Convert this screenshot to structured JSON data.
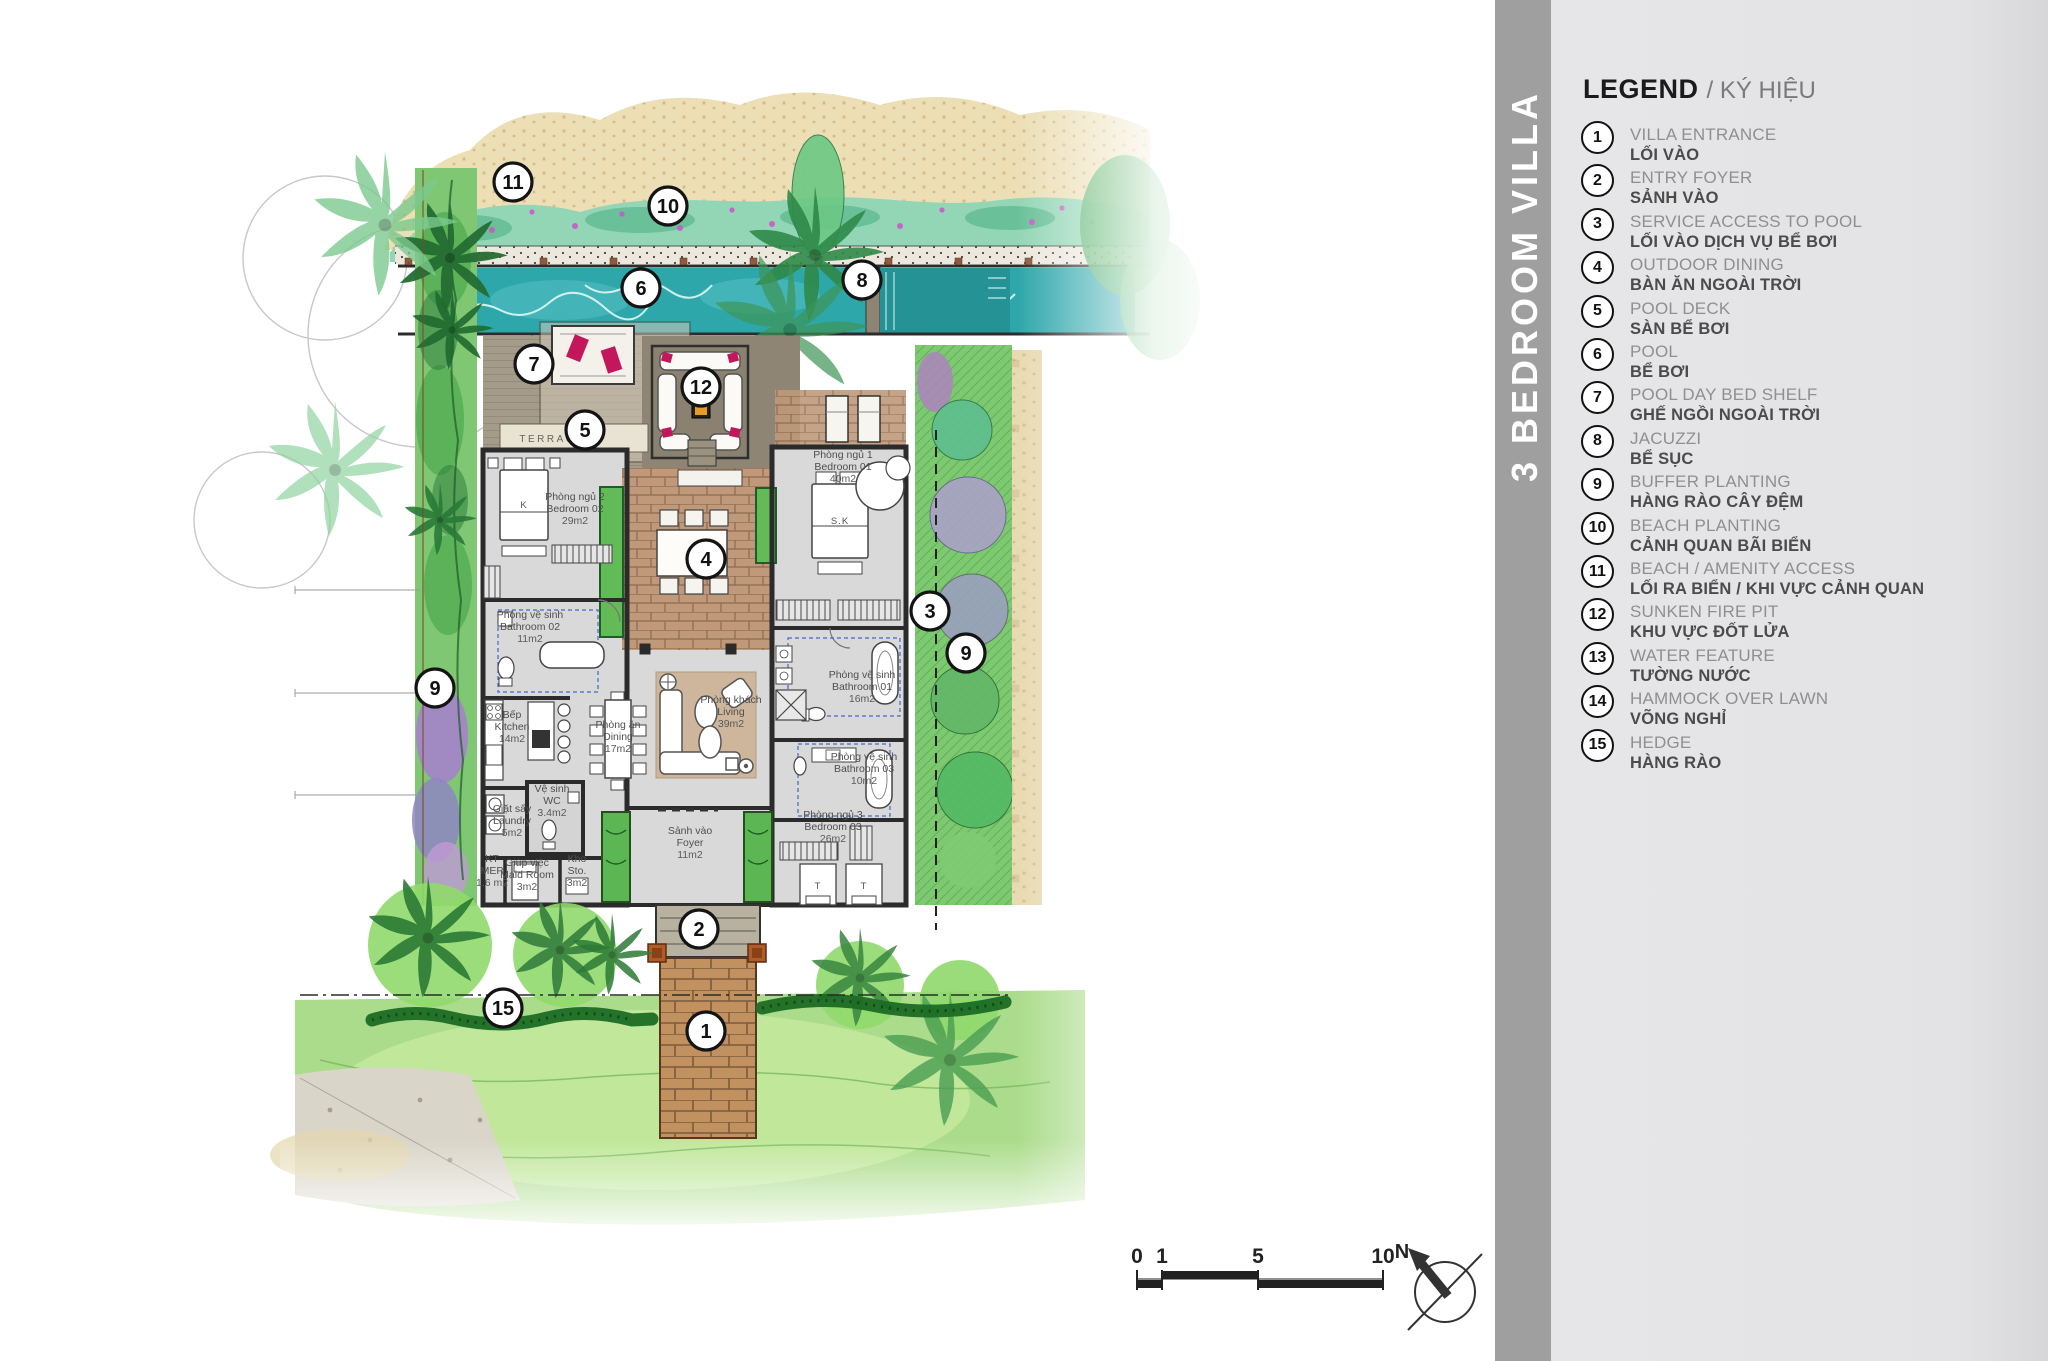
{
  "banner": {
    "title": "3 BEDROOM VILLA"
  },
  "legend": {
    "title": "LEGEND",
    "subtitle": "/ KÝ HIỆU",
    "items": [
      {
        "num": "1",
        "en": "VILLA ENTRANCE",
        "vi": "LỐI VÀO"
      },
      {
        "num": "2",
        "en": "ENTRY FOYER",
        "vi": "SẢNH VÀO"
      },
      {
        "num": "3",
        "en": "SERVICE ACCESS TO POOL",
        "vi": "LỐI VÀO DỊCH VỤ BỂ BƠI"
      },
      {
        "num": "4",
        "en": "OUTDOOR DINING",
        "vi": "BÀN ĂN NGOÀI TRỜI"
      },
      {
        "num": "5",
        "en": "POOL DECK",
        "vi": "SÀN BỂ BƠI"
      },
      {
        "num": "6",
        "en": "POOL",
        "vi": "BỂ BƠI"
      },
      {
        "num": "7",
        "en": "POOL DAY BED SHELF",
        "vi": "GHẾ NGỒI NGOÀI TRỜI"
      },
      {
        "num": "8",
        "en": "JACUZZI",
        "vi": "BỂ SỤC"
      },
      {
        "num": "9",
        "en": "BUFFER PLANTING",
        "vi": "HÀNG RÀO CÂY ĐỆM"
      },
      {
        "num": "10",
        "en": "BEACH PLANTING",
        "vi": "CẢNH QUAN BÃI BIỂN"
      },
      {
        "num": "11",
        "en": "BEACH / AMENITY ACCESS",
        "vi": "LỐI RA BIỂN / KHI VỰC CẢNH QUAN"
      },
      {
        "num": "12",
        "en": "SUNKEN FIRE PIT",
        "vi": "KHU VỰC ĐỐT LỬA"
      },
      {
        "num": "13",
        "en": "WATER FEATURE",
        "vi": "TƯỜNG NƯỚC"
      },
      {
        "num": "14",
        "en": "HAMMOCK OVER LAWN",
        "vi": "VÕNG NGHỈ"
      },
      {
        "num": "15",
        "en": "HEDGE",
        "vi": "HÀNG RÀO"
      }
    ]
  },
  "plan": {
    "terrace_label": "TERRACE",
    "markers": [
      {
        "num": "11",
        "x": 513,
        "y": 182
      },
      {
        "num": "10",
        "x": 668,
        "y": 206
      },
      {
        "num": "6",
        "x": 641,
        "y": 288
      },
      {
        "num": "8",
        "x": 862,
        "y": 280
      },
      {
        "num": "7",
        "x": 534,
        "y": 364
      },
      {
        "num": "12",
        "x": 701,
        "y": 387
      },
      {
        "num": "5",
        "x": 585,
        "y": 430
      },
      {
        "num": "4",
        "x": 706,
        "y": 559
      },
      {
        "num": "3",
        "x": 930,
        "y": 611
      },
      {
        "num": "9",
        "x": 966,
        "y": 653
      },
      {
        "num": "9",
        "x": 435,
        "y": 688
      },
      {
        "num": "2",
        "x": 699,
        "y": 929
      },
      {
        "num": "15",
        "x": 503,
        "y": 1008
      },
      {
        "num": "1",
        "x": 706,
        "y": 1031
      }
    ],
    "room_labels": [
      {
        "x": 575,
        "y": 500,
        "lines": [
          "Phòng ngủ 2",
          "Bedroom 02",
          "29m2"
        ]
      },
      {
        "x": 530,
        "y": 618,
        "lines": [
          "Phòng vệ sinh",
          "Bathroom 02",
          "11m2"
        ]
      },
      {
        "x": 512,
        "y": 718,
        "lines": [
          "Bếp",
          "Kitchen",
          "14m2"
        ]
      },
      {
        "x": 618,
        "y": 728,
        "lines": [
          "Phòng ăn",
          "Dining",
          "17m2"
        ]
      },
      {
        "x": 731,
        "y": 703,
        "lines": [
          "Phòng khách",
          "Living",
          "39m2"
        ]
      },
      {
        "x": 552,
        "y": 792,
        "lines": [
          "Vệ sinh",
          "WC",
          "3.4m2"
        ]
      },
      {
        "x": 512,
        "y": 812,
        "lines": [
          "Giặt sấy",
          "Laundry",
          "5m2"
        ]
      },
      {
        "x": 492,
        "y": 862,
        "lines": [
          "KT",
          "MEP",
          "1.6 m2"
        ]
      },
      {
        "x": 527,
        "y": 866,
        "lines": [
          "Giúp việc",
          "Maid Room",
          "3m2"
        ]
      },
      {
        "x": 577,
        "y": 862,
        "lines": [
          "Kho",
          "Sto.",
          "3m2"
        ]
      },
      {
        "x": 690,
        "y": 834,
        "lines": [
          "Sảnh vào",
          "Foyer",
          "11m2"
        ]
      },
      {
        "x": 843,
        "y": 458,
        "lines": [
          "Phòng ngủ 1",
          "Bedroom 01",
          "40m2"
        ]
      },
      {
        "x": 862,
        "y": 678,
        "lines": [
          "Phòng vệ sinh",
          "Bathroom 01",
          "16m2"
        ]
      },
      {
        "x": 864,
        "y": 760,
        "lines": [
          "Phòng vệ sinh",
          "Bathroom 03",
          "10m2"
        ]
      },
      {
        "x": 833,
        "y": 818,
        "lines": [
          "Phòng ngủ 3",
          "Bedroom 03",
          "26m2"
        ]
      }
    ],
    "bed_labels": [
      {
        "x": 524,
        "y": 508,
        "text": "K"
      },
      {
        "x": 840,
        "y": 524,
        "text": "S.K"
      },
      {
        "x": 818,
        "y": 889,
        "text": "T"
      },
      {
        "x": 864,
        "y": 889,
        "text": "T"
      }
    ]
  },
  "scale_bar": {
    "labels": [
      {
        "text": "0",
        "x": 1137
      },
      {
        "text": "1",
        "x": 1162
      },
      {
        "text": "5",
        "x": 1258
      },
      {
        "text": "10",
        "x": 1383
      }
    ]
  },
  "north_arrow": {
    "label": "N"
  },
  "colors": {
    "banner_bg": "#9f9f9f",
    "legend_panel_bg": "#e4e4e6",
    "pool": "#2ea7ab",
    "sand": "#ecdfb6",
    "foliage": "#7fc773",
    "purple_planting": "#a77fd0",
    "cushion_accent": "#c2185b",
    "wall": "#2b2b2b",
    "courtyard_brick": "#bf997a"
  }
}
